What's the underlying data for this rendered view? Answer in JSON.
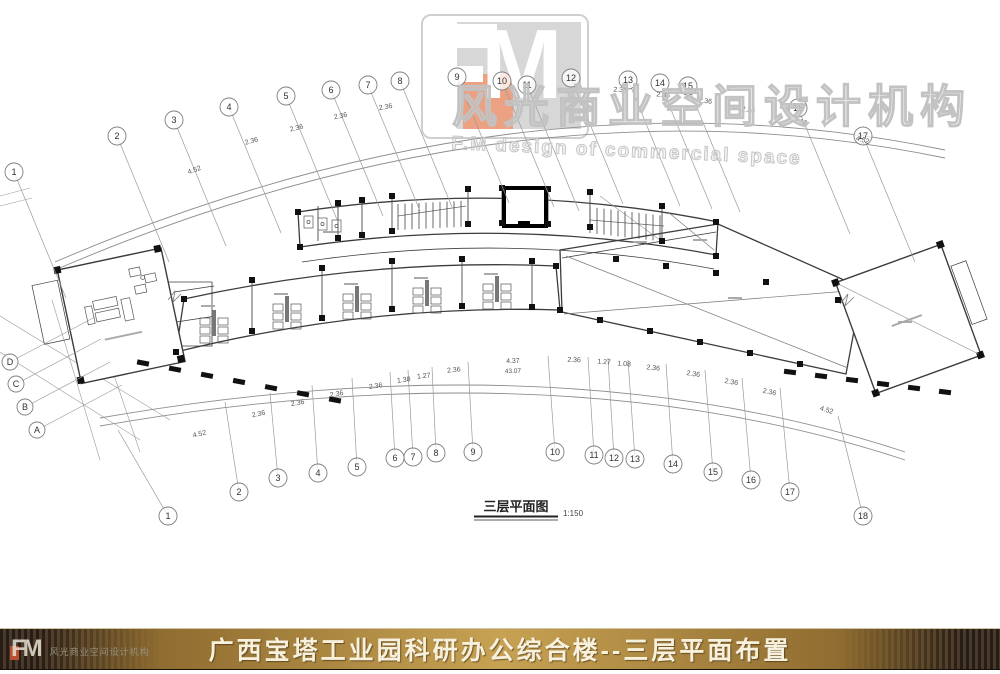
{
  "watermark": {
    "line1": "风光商业空间设计机构",
    "line2": "F.M design of commercial space"
  },
  "logo": {
    "f": "F",
    "m": "M"
  },
  "plan": {
    "title": "三层平面图",
    "scale": "1:150",
    "axis_top": [
      "1",
      "2",
      "3",
      "4",
      "5",
      "6",
      "7",
      "8",
      "9",
      "10",
      "11",
      "12",
      "13",
      "14",
      "15",
      "16",
      "17"
    ],
    "axis_bottom": [
      "1",
      "2",
      "3",
      "4",
      "5",
      "6",
      "7",
      "8",
      "9",
      "10",
      "11",
      "12",
      "13",
      "14",
      "15",
      "16",
      "17",
      "18"
    ],
    "axis_left": [
      "D",
      "C",
      "B",
      "A"
    ],
    "dims_bottom": [
      "4.52",
      "2.36",
      "2.36",
      "2.36",
      "2.36",
      "1.38",
      "1.27",
      "2.36",
      "4.37",
      "2.36",
      "1.27",
      "1.08",
      "2.36",
      "2.36",
      "2.36",
      "2.36",
      "4.52"
    ],
    "dims_bottom_total": "43.07",
    "dims_top": [
      "4.52",
      "2.36",
      "2.36",
      "2.36",
      "2.36",
      "2.36",
      "2.36",
      "2.36",
      "2.36",
      "2.36",
      "4.52"
    ]
  },
  "footer": {
    "title": "广西宝塔工业园科研办公综合楼--三层平面布置",
    "logo_text": "风光商业空间设计机构",
    "colors": {
      "gold": "#c7a253",
      "gold_dark": "#8f6c30",
      "stripe_dark": "#261d16",
      "stripe_light": "#4a3a2b",
      "text": "#f7f0dd",
      "logo_salmon": "#eda183",
      "logo_gray": "#d7d7d7"
    }
  }
}
